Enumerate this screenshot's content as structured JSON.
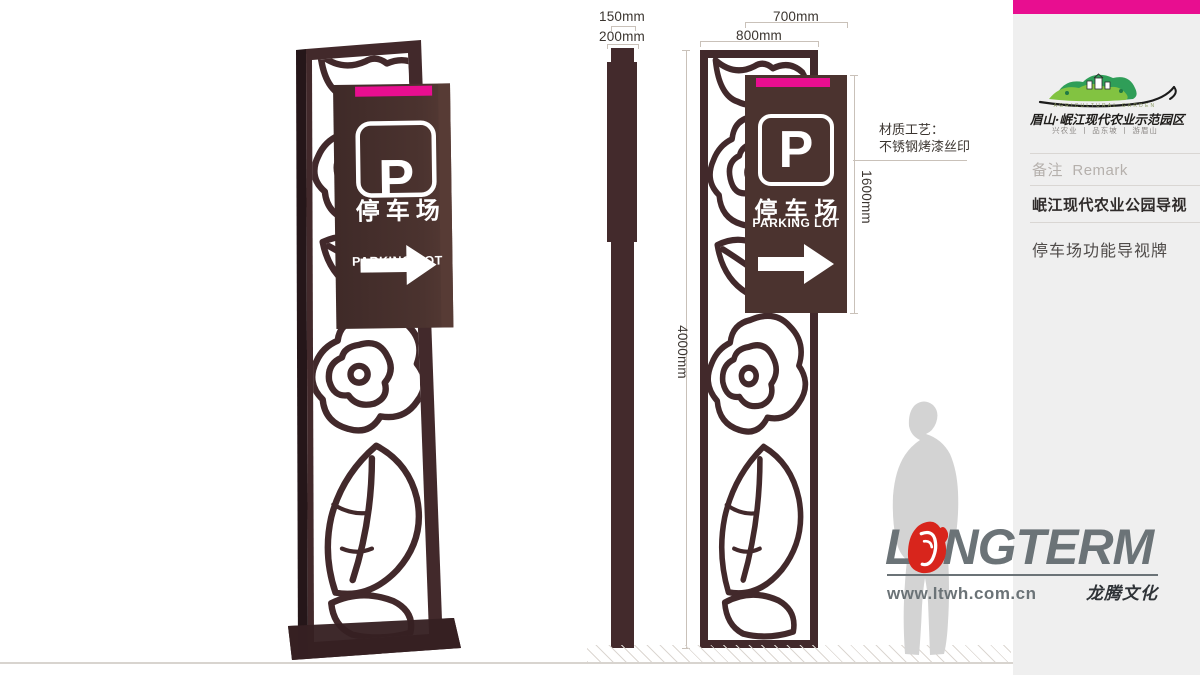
{
  "dimensions": {
    "pole_top_width": "150mm",
    "pole_width": "200mm",
    "panel_width": "700mm",
    "frame_width": "800mm",
    "panel_height": "1600mm",
    "total_height": "4000mm"
  },
  "material_note": {
    "line1": "材质工艺：",
    "line2": "不锈钢烤漆丝印"
  },
  "sign": {
    "p_symbol": "P",
    "title_cn": "停车场",
    "title_en": "PARKING LOT"
  },
  "sidebar": {
    "brand": {
      "garden_en": "AGRICULTURAL GARDEN",
      "garden_cn": "眉山·岷江现代农业示范园区",
      "slogan": "兴农业 丨 品东坡 丨 游眉山"
    },
    "remark_cn": "备注",
    "remark_en": "Remark",
    "project_title": "岷江现代农业公园导视",
    "item_title": "停车场功能导视牌"
  },
  "brand_footer": {
    "wordmark_prefix": "L",
    "wordmark_suffix": "NGTERM",
    "website": "www.ltwh.com.cn",
    "company_cn": "龙腾文化"
  },
  "colors": {
    "structure_brown": "#42292b",
    "panel_brown": "#4b332f",
    "magenta_accent": "#e80e90",
    "sidebar_bg": "#efefef",
    "dimension_line": "#c9c1b9",
    "silhouette_gray": "#d3d3d3",
    "langterm_gray": "#6b7377",
    "langterm_red": "#d8251c",
    "hill_green_dark": "#2f9e58",
    "hill_green_light": "#82c341"
  }
}
